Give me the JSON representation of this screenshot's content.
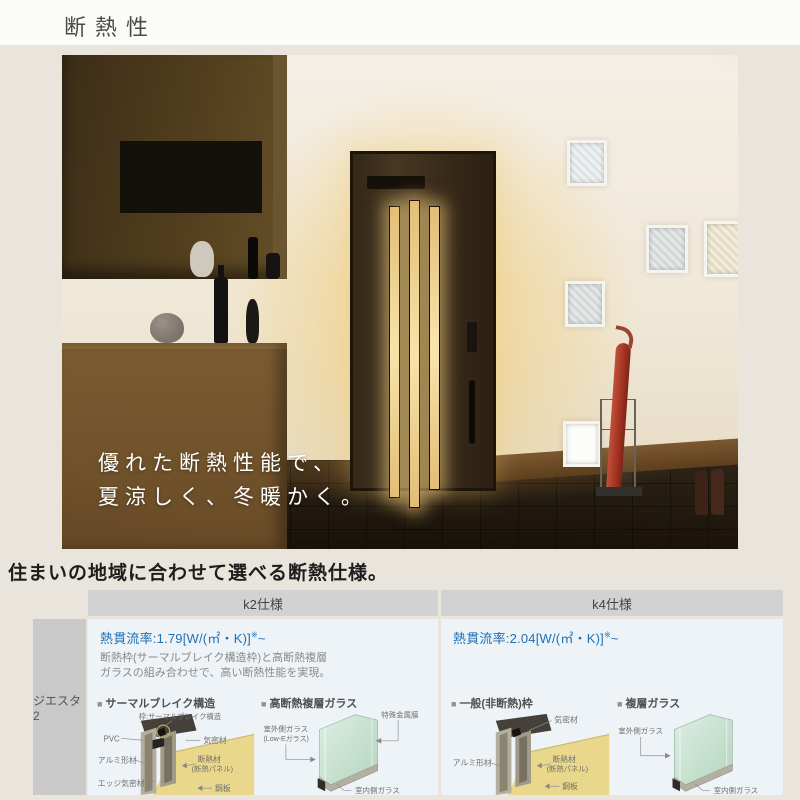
{
  "page": {
    "title": "断熱性"
  },
  "hero": {
    "caption_line1": "優れた断熱性能で、",
    "caption_line2": "夏涼しく、冬暖かく。"
  },
  "section_heading": "住まいの地域に合わせて選べる断熱仕様。",
  "product": {
    "name": "ジエスタ2"
  },
  "ui": {
    "bullet": "■"
  },
  "table": {
    "columns": [
      {
        "header": "k2仕様",
        "u_value": "熱貫流率:1.79[W/(㎡・K)]",
        "u_sup": "※",
        "u_tail": "~",
        "desc1": "断熱枠(サーマルブレイク構造枠)と高断熱複層",
        "desc2": "ガラスの組み合わせで、高い断熱性能を実現。",
        "frame": {
          "title": "サーマルブレイク構造",
          "label_top": "枠:サーマルブレイク構造",
          "label_pvc": "PVC",
          "label_airtight": "気密材",
          "label_aluminum": "アルミ形材",
          "label_insulation1": "断熱材",
          "label_insulation2": "(断熱パネル)",
          "label_edge": "エッジ気密材",
          "label_steel": "鋼板"
        },
        "glass": {
          "title": "高断熱複層ガラス",
          "label_film": "特殊金属膜",
          "label_outer1": "室外側ガラス",
          "label_outer2": "(Low-Eガラス)",
          "label_inner": "室内側ガラス"
        }
      },
      {
        "header": "k4仕様",
        "u_value": "熱貫流率:2.04[W/(㎡・K)]",
        "u_sup": "※",
        "u_tail": "~",
        "frame": {
          "title": "一般(非断熱)枠",
          "label_airtight": "気密材",
          "label_aluminum": "アルミ形材",
          "label_insulation1": "断熱材",
          "label_insulation2": "(断熱パネル)",
          "label_steel": "鋼板"
        },
        "glass": {
          "title": "複層ガラス",
          "label_outer1": "室外側ガラス",
          "label_inner": "室内側ガラス"
        }
      }
    ]
  },
  "colors": {
    "accent_blue": "#1f6fb5",
    "header_gray": "#d2d2d2",
    "sidebar_gray": "#c9c9c9",
    "cell_blue": "#eef3f7",
    "door_glow": "#f2ce7a",
    "umbrella_red": "#a53523",
    "insulation_yellow": "#e9d88b"
  }
}
